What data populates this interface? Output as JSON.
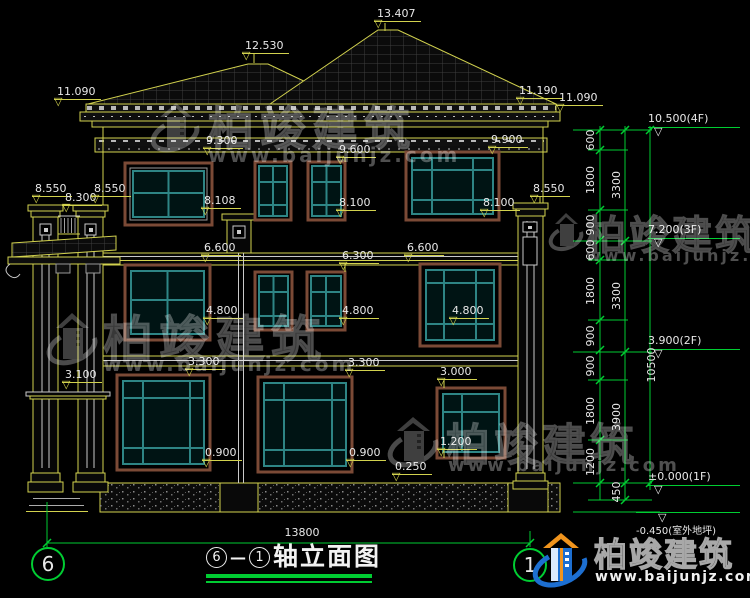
{
  "watermark": {
    "brand": "柏竣建筑",
    "url": "www.baijunjz.com"
  },
  "footer_logo": {
    "brand": "柏竣建筑",
    "url": "www.baijunjz.com"
  },
  "title": {
    "axis_left": "6",
    "dash": "—",
    "axis_right": "1",
    "name": "轴立面图"
  },
  "axis_bubbles": {
    "left": "6",
    "right": "1"
  },
  "bottom_dim": {
    "total": "13800"
  },
  "right_dims": {
    "segments": [
      "600",
      "1800",
      "900",
      "600",
      "1800",
      "900",
      "900",
      "1800",
      "1200"
    ],
    "floors": [
      "3300",
      "3300",
      "3900"
    ],
    "total": "10500",
    "below_ground": "450"
  },
  "right_levels": [
    "10.500(4F)",
    "7.200(3F)",
    "3.900(2F)",
    "±0.000(1F)",
    "-0.450(室外地坪)"
  ],
  "facade_levels": [
    "13.407",
    "12.530",
    "11.090",
    "11.190",
    "11.090",
    "9.300",
    "9.600",
    "9.900",
    "8.550",
    "8.300",
    "8.550",
    "8.550",
    "8.108",
    "8.100",
    "8.100",
    "6.600",
    "6.600",
    "6.300",
    "4.800",
    "4.800",
    "4.800",
    "3.300",
    "3.300",
    "3.100",
    "3.000",
    "1.200",
    "0.900",
    "0.900",
    "0.250"
  ]
}
